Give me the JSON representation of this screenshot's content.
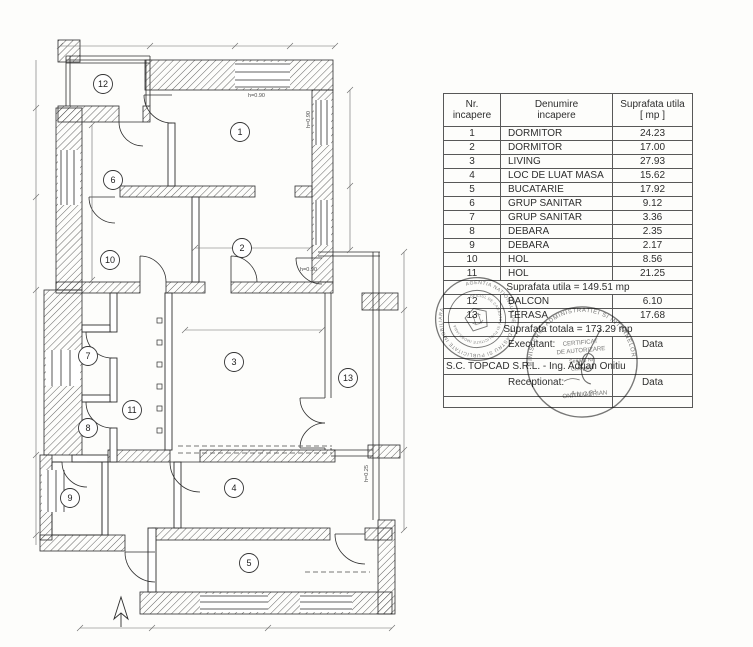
{
  "table": {
    "header": {
      "col1": "Nr.\nincapere",
      "col2": "Denumire\nincapere",
      "col3": "Suprafata utila\n[ mp ]"
    },
    "rows": [
      {
        "nr": "1",
        "name": "DORMITOR",
        "area": "24.23"
      },
      {
        "nr": "2",
        "name": "DORMITOR",
        "area": "17.00"
      },
      {
        "nr": "3",
        "name": "LIVING",
        "area": "27.93"
      },
      {
        "nr": "4",
        "name": "LOC DE LUAT MASA",
        "area": "15.62"
      },
      {
        "nr": "5",
        "name": "BUCATARIE",
        "area": "17.92"
      },
      {
        "nr": "6",
        "name": "GRUP SANITAR",
        "area": "9.12"
      },
      {
        "nr": "7",
        "name": "GRUP SANITAR",
        "area": "3.36"
      },
      {
        "nr": "8",
        "name": "DEBARA",
        "area": "2.35"
      },
      {
        "nr": "9",
        "name": "DEBARA",
        "area": "2.17"
      },
      {
        "nr": "10",
        "name": "HOL",
        "area": "8.56"
      },
      {
        "nr": "11",
        "name": "HOL",
        "area": "21.25"
      }
    ],
    "subtotal": "Suprafata utila = 149.51 mp",
    "rows2": [
      {
        "nr": "12",
        "name": "BALCON",
        "area": "6.10"
      },
      {
        "nr": "13",
        "name": "TERASA",
        "area": "17.68"
      }
    ],
    "total": "Suprafata totala = 173.29 mp",
    "executant_label": "Executant:",
    "executant_company": "S.C. TOPCAD S.R.L. - Ing. Adrian Onitiu",
    "receptionat_label": "Receptionat:",
    "data_label": "Data"
  },
  "plan": {
    "rooms": [
      {
        "label": "1"
      },
      {
        "label": "2"
      },
      {
        "label": "3"
      },
      {
        "label": "4"
      },
      {
        "label": "5"
      },
      {
        "label": "6"
      },
      {
        "label": "7"
      },
      {
        "label": "8"
      },
      {
        "label": "9"
      },
      {
        "label": "10"
      },
      {
        "label": "11"
      },
      {
        "label": "12"
      },
      {
        "label": "13"
      }
    ],
    "annotations": [
      {
        "text": "h=0.90"
      },
      {
        "text": "h=0.90"
      },
      {
        "text": "h=0.90"
      },
      {
        "text": "h=0.25"
      }
    ]
  },
  "stamps": {
    "left": {
      "ring_outer": "AGENTIA NATIONALA DE CADASTRU SI PUBLICITATE IMOBILIARA",
      "ring_inner": "OFICIUL DE CADASTRU SI PUBLICITATE IMOBILIARA"
    },
    "right": {
      "ring_top": "MINISTERUL ADMINISTRATIEI SI INTERNELOR",
      "ring_bottom": "ANCPI",
      "lines": [
        "CERTIFICAT",
        "DE AUTORIZARE",
        "Seria B Nr.",
        "Categoria",
        "ONITIU ADRIAN"
      ]
    }
  }
}
